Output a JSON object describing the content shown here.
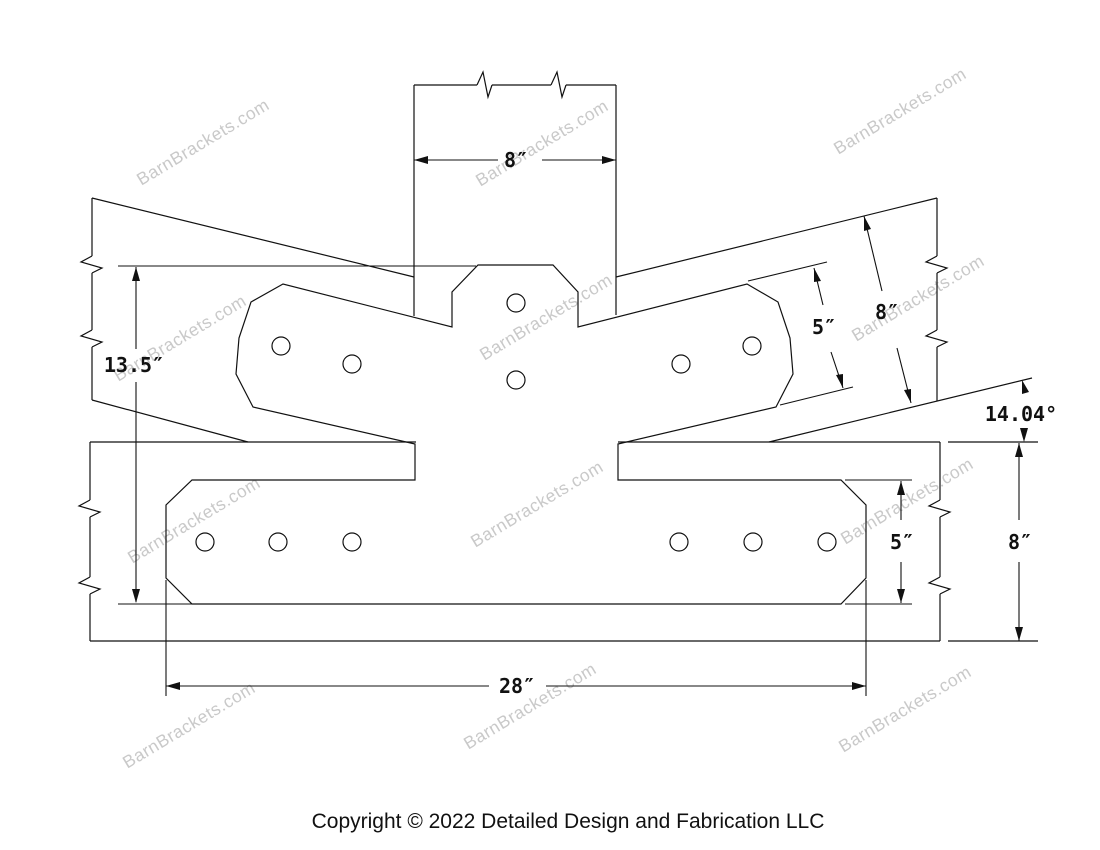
{
  "watermark": {
    "text": "BarnBrackets.com"
  },
  "footer": {
    "copyright": "Copyright © 2022 Detailed Design and Fabrication LLC"
  },
  "dimensions": {
    "post_width": "8″",
    "overall_plate_height": "13.5″",
    "rafter_plate_width": "5″",
    "rafter_beam_width": "8″",
    "pitch_angle": "14.04°",
    "bottom_plate_height": "5″",
    "bottom_beam_height": "8″",
    "bottom_plate_length": "28″"
  }
}
